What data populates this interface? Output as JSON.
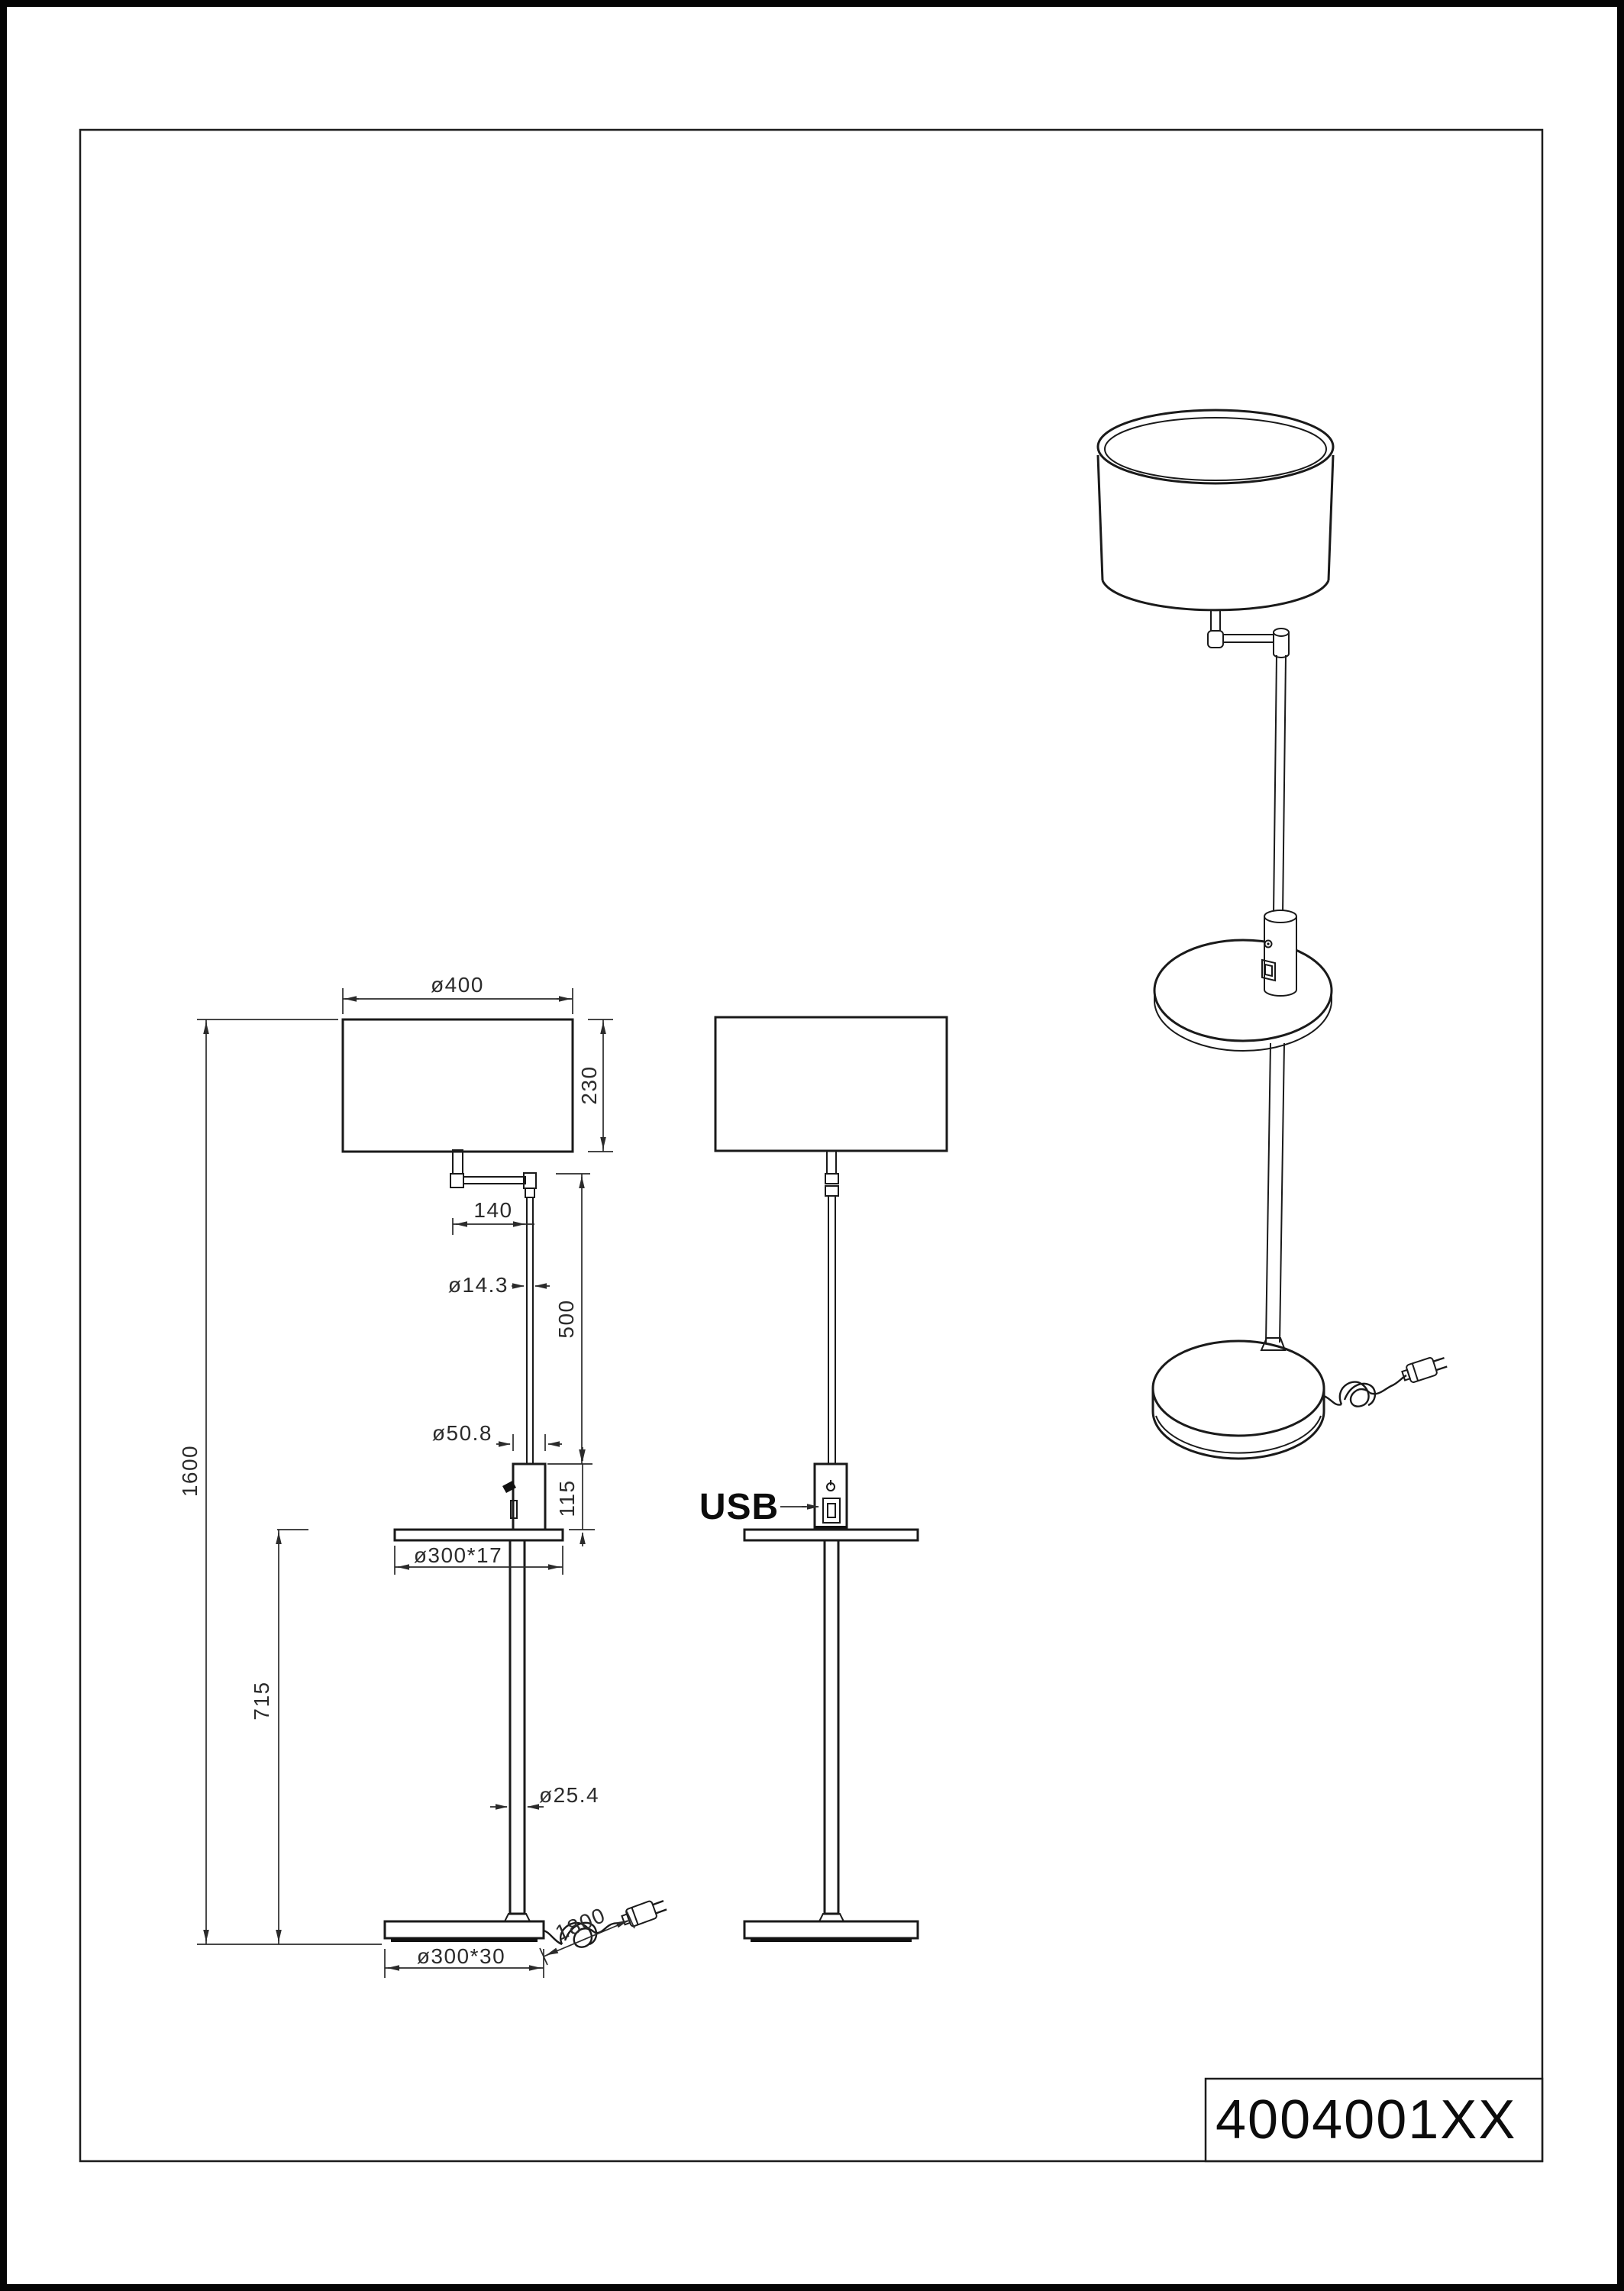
{
  "sheet": {
    "part_number": "4004001XX",
    "labels": {
      "usb": "USB"
    },
    "dimensions": {
      "shade_diameter": "ø400",
      "shade_height": "230",
      "arm_length": "140",
      "upper_pole_diameter": "ø14.3",
      "upper_pole_length": "500",
      "usb_body_diameter": "ø50.8",
      "usb_body_height": "115",
      "table_size": "ø300*17",
      "total_height": "1600",
      "table_height": "715",
      "lower_pole_diameter": "ø25.4",
      "base_size": "ø300*30",
      "cord_length": "1800"
    },
    "colors": {
      "ink": "#1a1a1a",
      "dim_ink": "#2b2b2b",
      "paper": "#ffffff"
    }
  }
}
